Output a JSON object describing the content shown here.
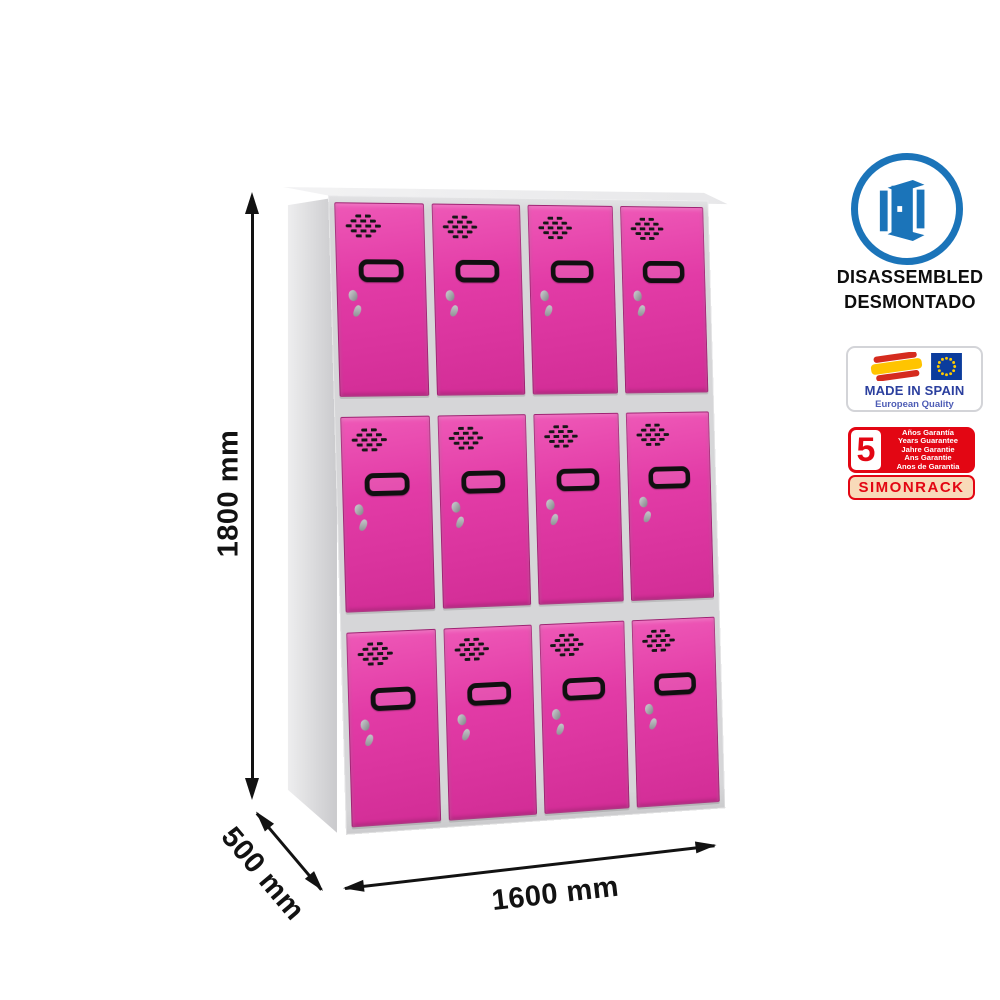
{
  "dimensions": {
    "height": "1800 mm",
    "depth": "500 mm",
    "width": "1600 mm"
  },
  "product": {
    "locker": {
      "rows": 3,
      "columns": 4,
      "door_color": "#e23ba6",
      "frame_color": "#d6d6d8"
    }
  },
  "badges": {
    "disassembled": {
      "line1": "DISASSEMBLED",
      "line2": "DESMONTADO",
      "icon": "open-door-icon",
      "accent_color": "#1b74b9"
    },
    "made_in_spain": {
      "title": "MADE IN SPAIN",
      "subtitle": "European Quality"
    },
    "guarantee": {
      "number": "5",
      "lines": [
        "Años Garantía",
        "Years Guarantee",
        "Jahre Garantie",
        "Ans Garantie",
        "Anos de Garantia"
      ],
      "brand": "SIMONRACK",
      "accent_color": "#e30613"
    }
  }
}
